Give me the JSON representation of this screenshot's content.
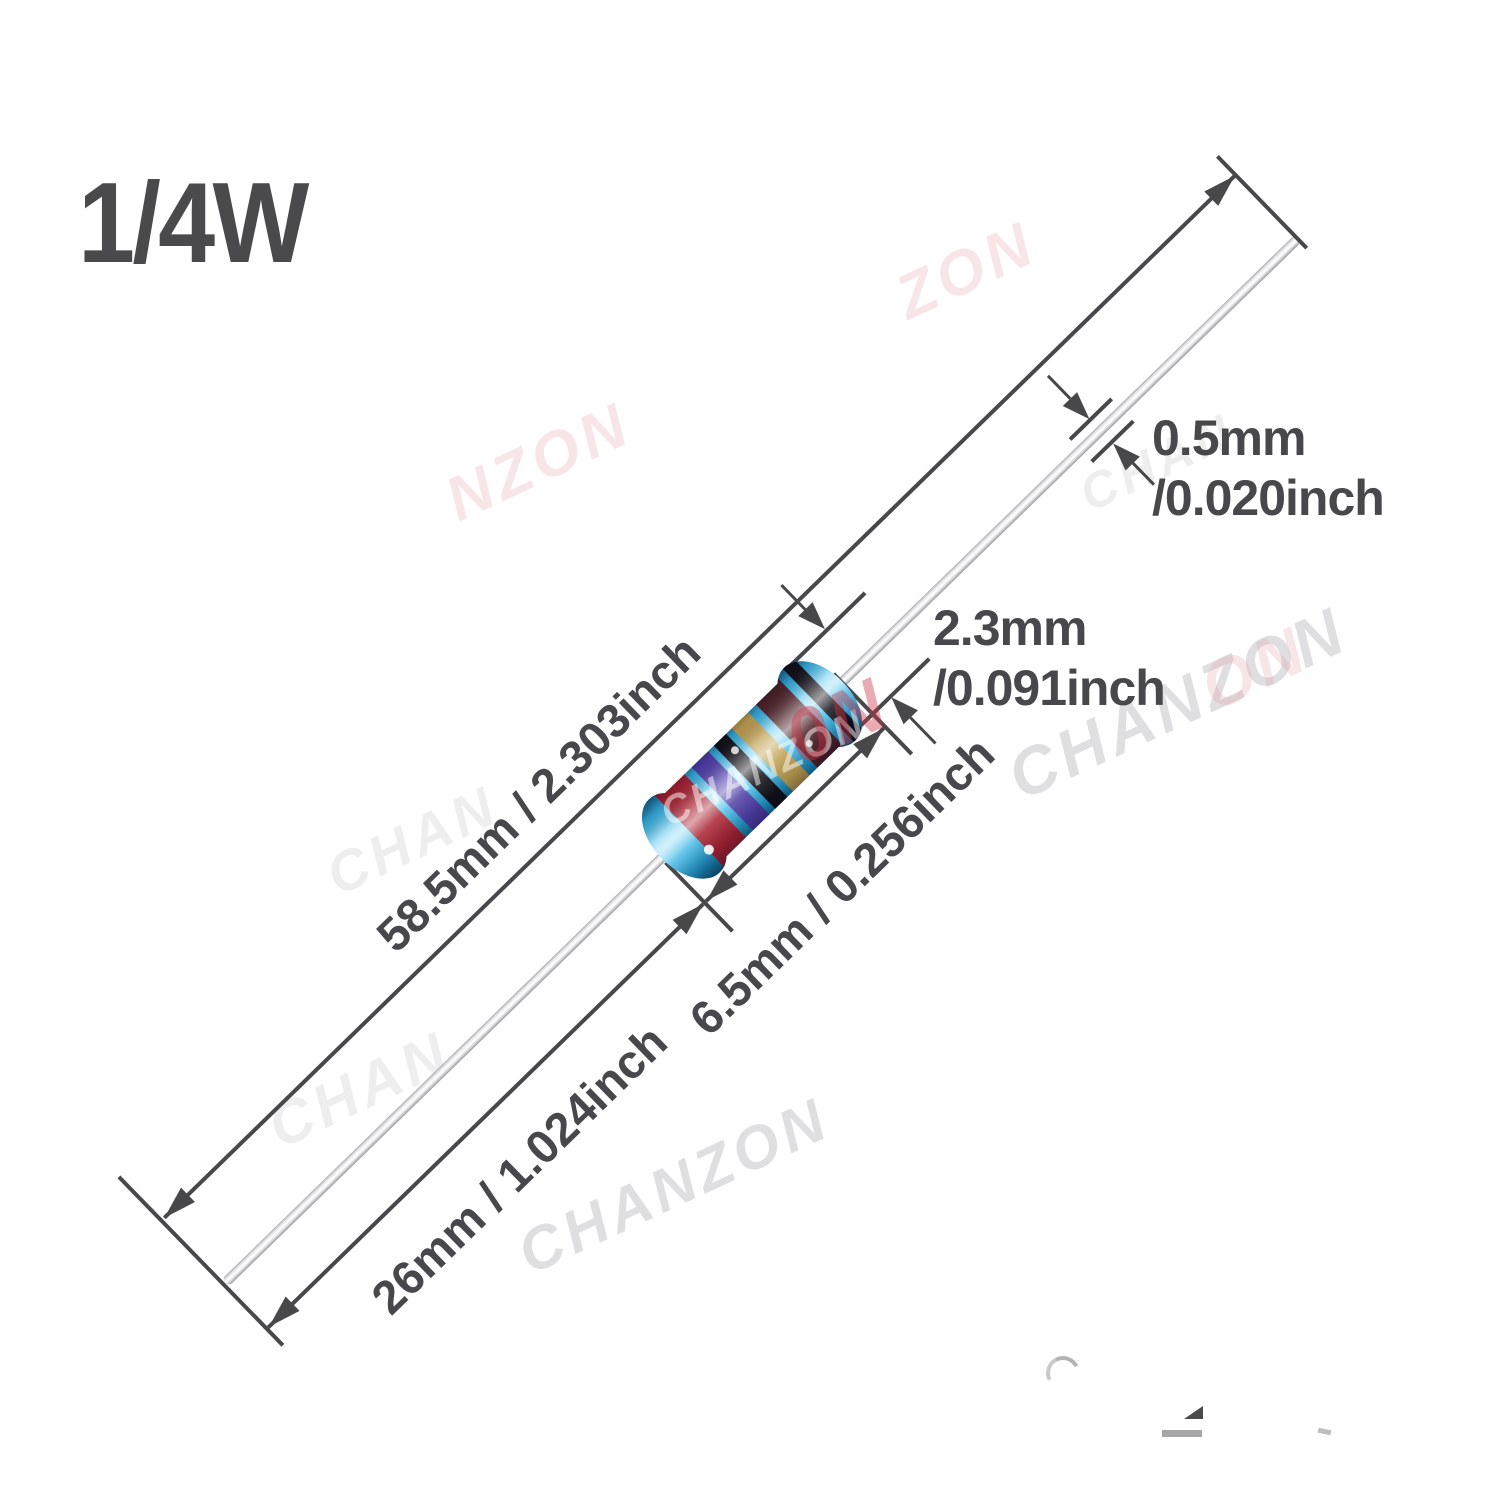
{
  "title": "1/4W",
  "labels": {
    "total_length": "58.5mm / 2.303inch",
    "lead_length": "26mm / 1.024inch",
    "body_length": "6.5mm / 0.256inch",
    "body_diameter_mm": "2.3mm",
    "body_diameter_inch": "/0.091inch",
    "lead_diameter_mm": "0.5mm",
    "lead_diameter_inch": "/0.020inch"
  },
  "resistor": {
    "type": "metal film resistor",
    "body_color": "#3cb4e2",
    "bands": [
      {
        "name": "red",
        "hex": "#aa2433"
      },
      {
        "name": "violet",
        "hex": "#503fa8"
      },
      {
        "name": "black",
        "hex": "#141218"
      },
      {
        "name": "gold",
        "hex": "#c0a050"
      },
      {
        "name": "brown",
        "hex": "#4f2429"
      },
      {
        "name": "black",
        "hex": "#16141b"
      }
    ]
  },
  "watermark": {
    "brand": "CHANZON",
    "fragments": [
      {
        "text": "NZON"
      },
      {
        "text": "ZON"
      },
      {
        "text": "CHANZON"
      },
      {
        "text": "ON"
      },
      {
        "text": "CHANZON"
      },
      {
        "text": "CHAN"
      },
      {
        "text": "CHAN"
      },
      {
        "text": "CHAN"
      },
      {
        "text": "0N"
      },
      {
        "text": "CHANZON"
      }
    ]
  },
  "colors": {
    "dimension_lines": "#48484b",
    "label_text": "#48484c",
    "wire_silver": "#d9d9dc"
  }
}
